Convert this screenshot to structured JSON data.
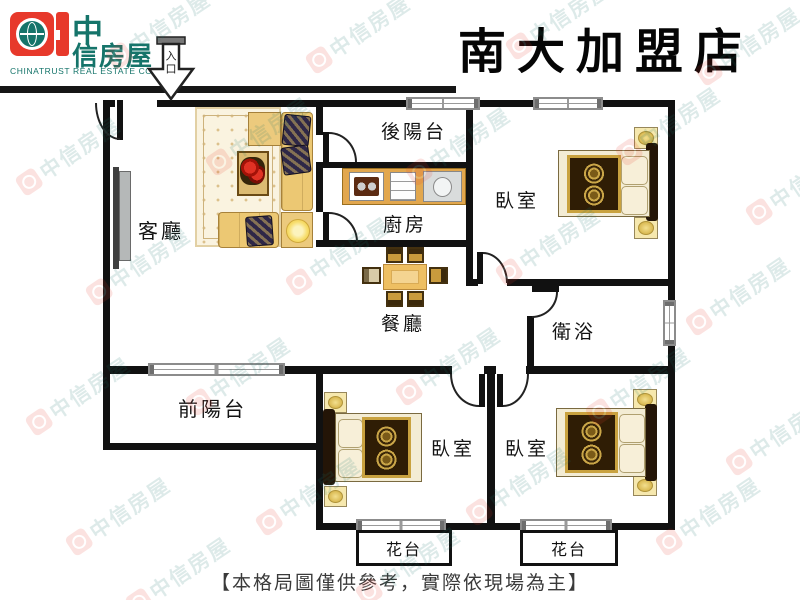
{
  "header": {
    "logo_cn_top": "中",
    "logo_cn_bottom": "信房屋",
    "logo_en": "CHINATRUST REAL ESTATE CO.",
    "store_title": "南大加盟店",
    "entrance_label": "入口"
  },
  "rooms": {
    "living": "客廳",
    "back_balcony": "後陽台",
    "kitchen": "廚房",
    "bedroom_top": "臥室",
    "bathroom": "衛浴",
    "dining": "餐廳",
    "front_balcony": "前陽台",
    "bedroom_mid": "臥室",
    "bedroom_right": "臥室",
    "flower_left": "花台",
    "flower_right": "花台"
  },
  "footer": {
    "disclaimer": "【本格局圖僅供參考，實際依現場為主】"
  },
  "watermark": {
    "text": "中信房屋"
  },
  "colors": {
    "brand_red": "#e7392b",
    "brand_teal": "#15746a",
    "wall": "#111111",
    "wood": "#e2a74e"
  }
}
